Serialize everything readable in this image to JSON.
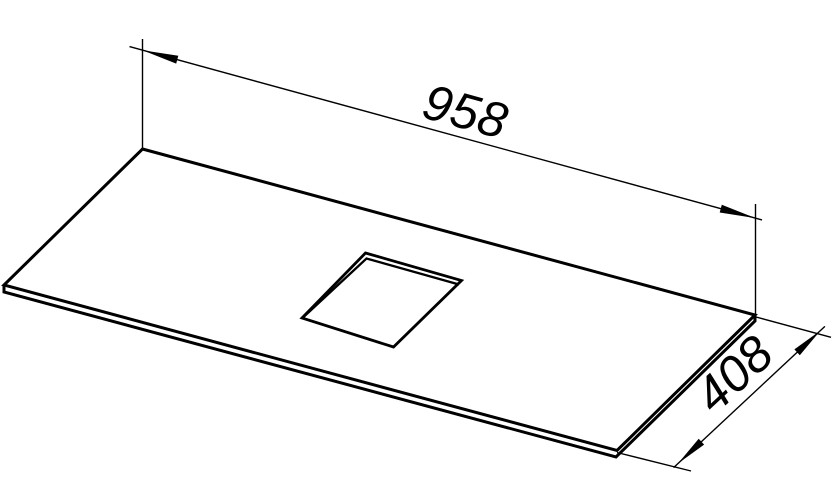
{
  "drawing": {
    "background": "#ffffff",
    "line_color": "#000000",
    "dimensions": {
      "length_label": "958",
      "depth_label": "408"
    }
  }
}
